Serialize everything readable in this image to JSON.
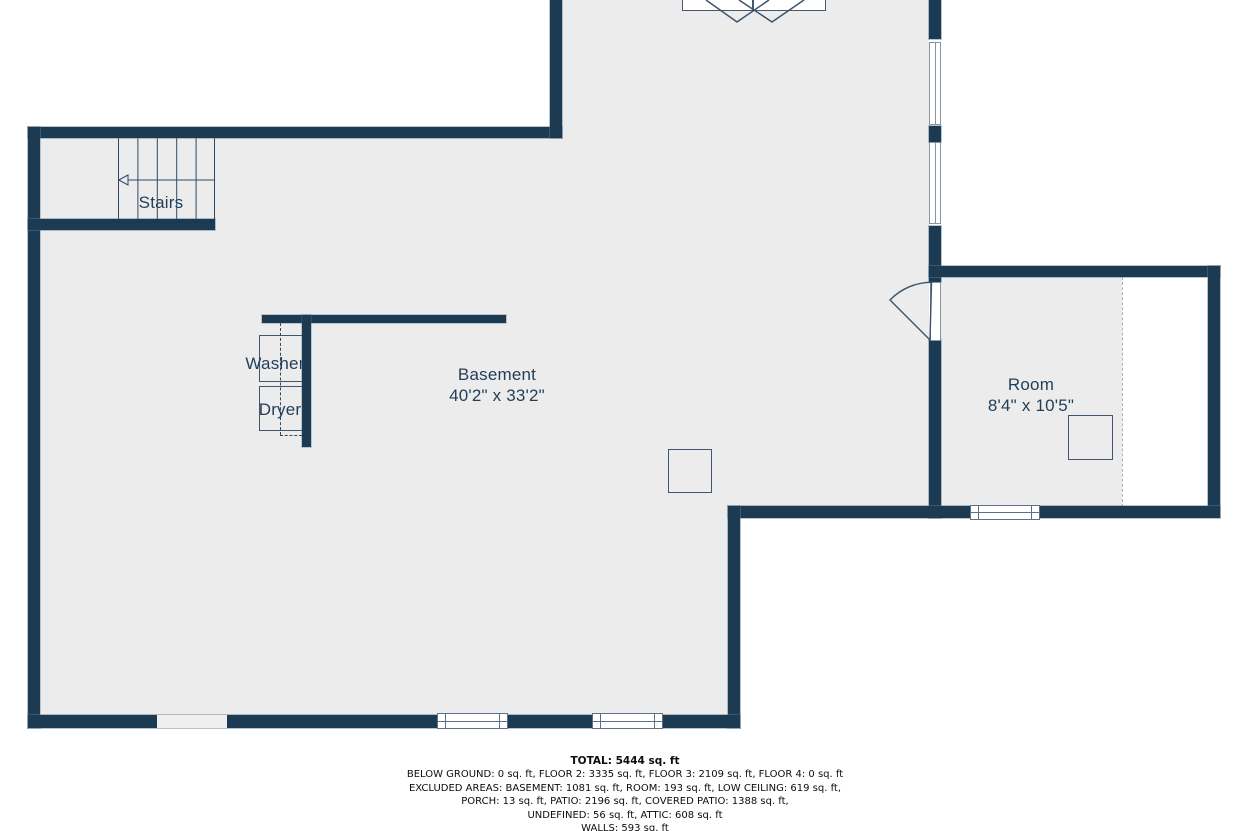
{
  "labels": {
    "stairs": "Stairs",
    "washer": "Washer",
    "dryer": "Dryer",
    "basement": {
      "name": "Basement",
      "dims": "40'2\" x 33'2\""
    },
    "room": {
      "name": "Room",
      "dims": "8'4\" x 10'5\""
    }
  },
  "summary": {
    "total": "TOTAL: 5444 sq. ft",
    "lines": [
      "BELOW GROUND: 0 sq. ft, FLOOR 2: 3335 sq. ft, FLOOR 3: 2109 sq. ft, FLOOR 4: 0 sq. ft",
      "EXCLUDED AREAS: BASEMENT: 1081 sq. ft, ROOM: 193 sq. ft, LOW CEILING: 619 sq. ft,",
      "PORCH: 13 sq. ft, PATIO: 2196 sq. ft, COVERED PATIO: 1388 sq. ft,",
      "UNDEFINED: 56 sq. ft, ATTIC: 608 sq. ft"
    ],
    "walls_line": "WALLS: 593 sq. ft"
  },
  "colors": {
    "wall": "#1d3a53",
    "floor": "#ececed",
    "label_text": "#1f3e58",
    "outline": "#41566c",
    "window_frame": "#5c7086"
  }
}
